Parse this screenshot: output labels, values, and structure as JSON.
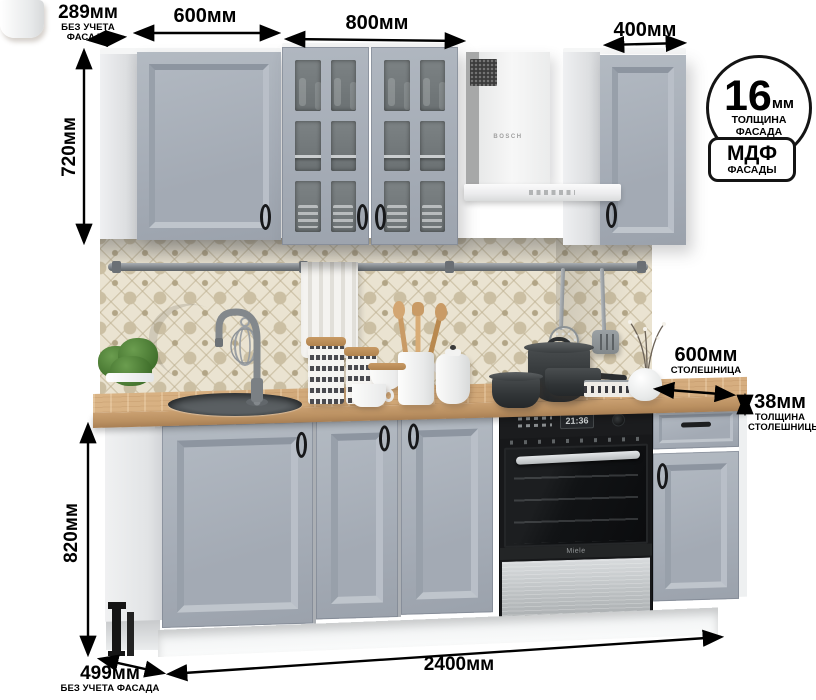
{
  "dims": {
    "wall_depth": "289мм",
    "wall_depth_note": "БЕЗ УЧЕТА ФАСАДА",
    "wall_600": "600мм",
    "wall_800": "800мм",
    "wall_400": "400мм",
    "wall_height": "720мм",
    "base_height": "820мм",
    "base_depth": "499мм",
    "base_depth_note": "БЕЗ УЧЕТА ФАСАДА",
    "total_width": "2400мм",
    "counter_depth": "600мм",
    "counter_depth_note": "СТОЛЕШНИЦА",
    "counter_thickness": "38мм",
    "counter_thickness_note1": "ТОЛЩИНА",
    "counter_thickness_note2": "СТОЛЕШНИЦЫ"
  },
  "badges": {
    "facade_thickness": {
      "value": "16",
      "unit": "мм",
      "note1": "ТОЛЩИНА",
      "note2": "ФАСАДА"
    },
    "material": {
      "value": "МДФ",
      "note": "ФАСАДЫ"
    }
  },
  "appliances": {
    "hood_brand": "BOSCH",
    "oven_brand": "Miele",
    "oven_clock": "21:36"
  },
  "colors": {
    "facade_gray": "#a8afb9",
    "carcass_white": "#eceeef",
    "countertop_wood": "#d2a97b",
    "backsplash_beige": "#eae3d1",
    "hood_white": "#f3f4f4",
    "oven_black": "#141516",
    "annotation_black": "#000000"
  }
}
